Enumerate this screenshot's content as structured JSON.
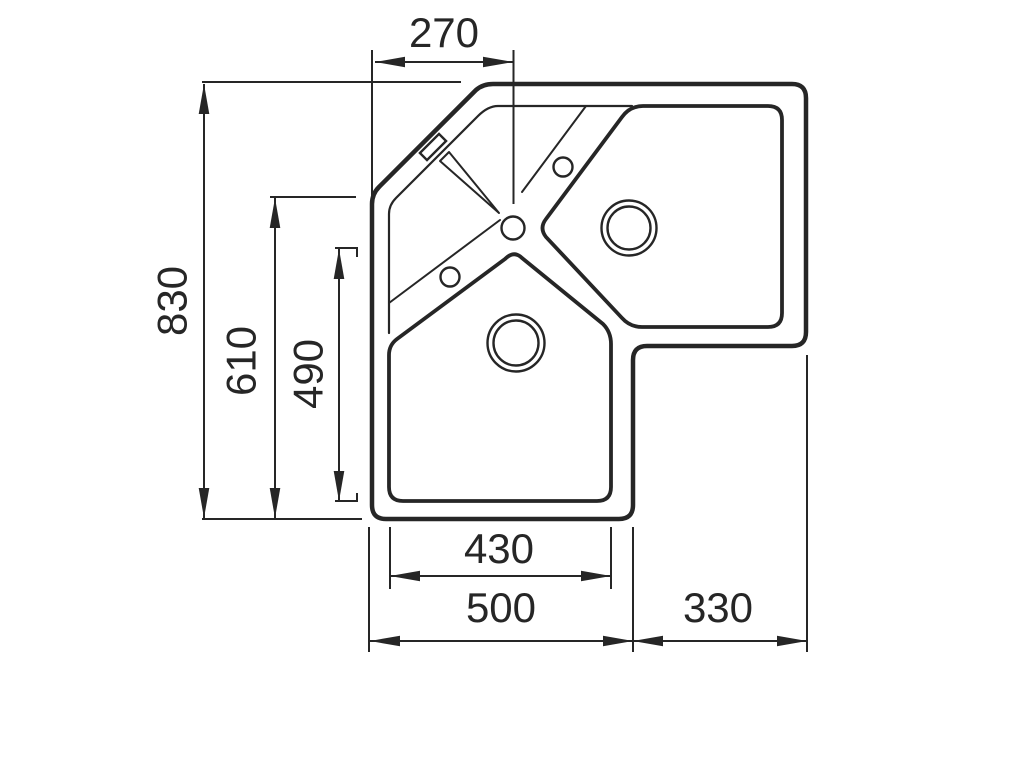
{
  "diagram": {
    "background_color": "#ffffff",
    "line_color": "#262626",
    "dimensions": {
      "top_width": "270",
      "overall_height": "830",
      "left_inner_height": "610",
      "bowl_height": "490",
      "bottom_bowl_width": "430",
      "bottom_section_width": "500",
      "right_section_width": "330"
    }
  }
}
